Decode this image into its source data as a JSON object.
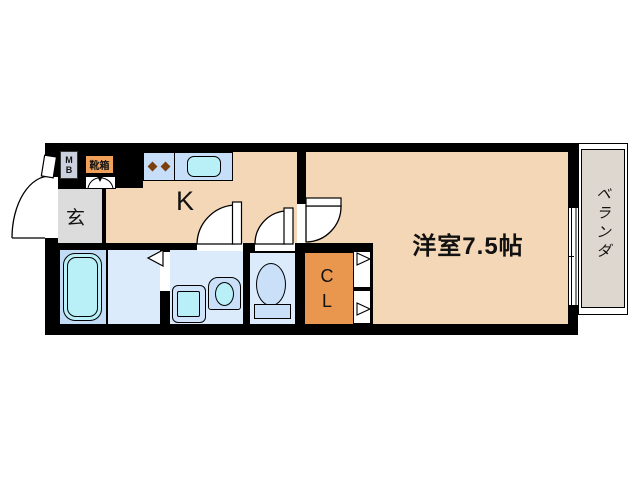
{
  "floorplan": {
    "rooms": {
      "kitchen_label": "K",
      "entrance_label": "玄",
      "main_room_label": "洋室7.5帖",
      "veranda_label": "ベランダ",
      "closet_label_line1": "C",
      "closet_label_line2": "L",
      "meter_box_line1": "M",
      "meter_box_line2": "B",
      "shoe_box_label": "靴箱"
    },
    "colors": {
      "wall": "#000000",
      "floor_main_peach": "#F4D7B6",
      "floor_entrance_gray": "#DCDCDC",
      "floor_wet_light_blue": "#DCEBFB",
      "floor_bath_blue": "#C2DCF6",
      "fixture_cyan": "#B9F0F8",
      "fixture_light_blue": "#C9E0F8",
      "kitchen_counter_blue": "#C6DEF8",
      "closet_orange": "#E9964F",
      "shoe_box_orange": "#F1A159",
      "meter_box_gray": "#CBD0DE",
      "veranda_gray": "#DED7CF",
      "burner_brown": "#7B3F10"
    }
  }
}
